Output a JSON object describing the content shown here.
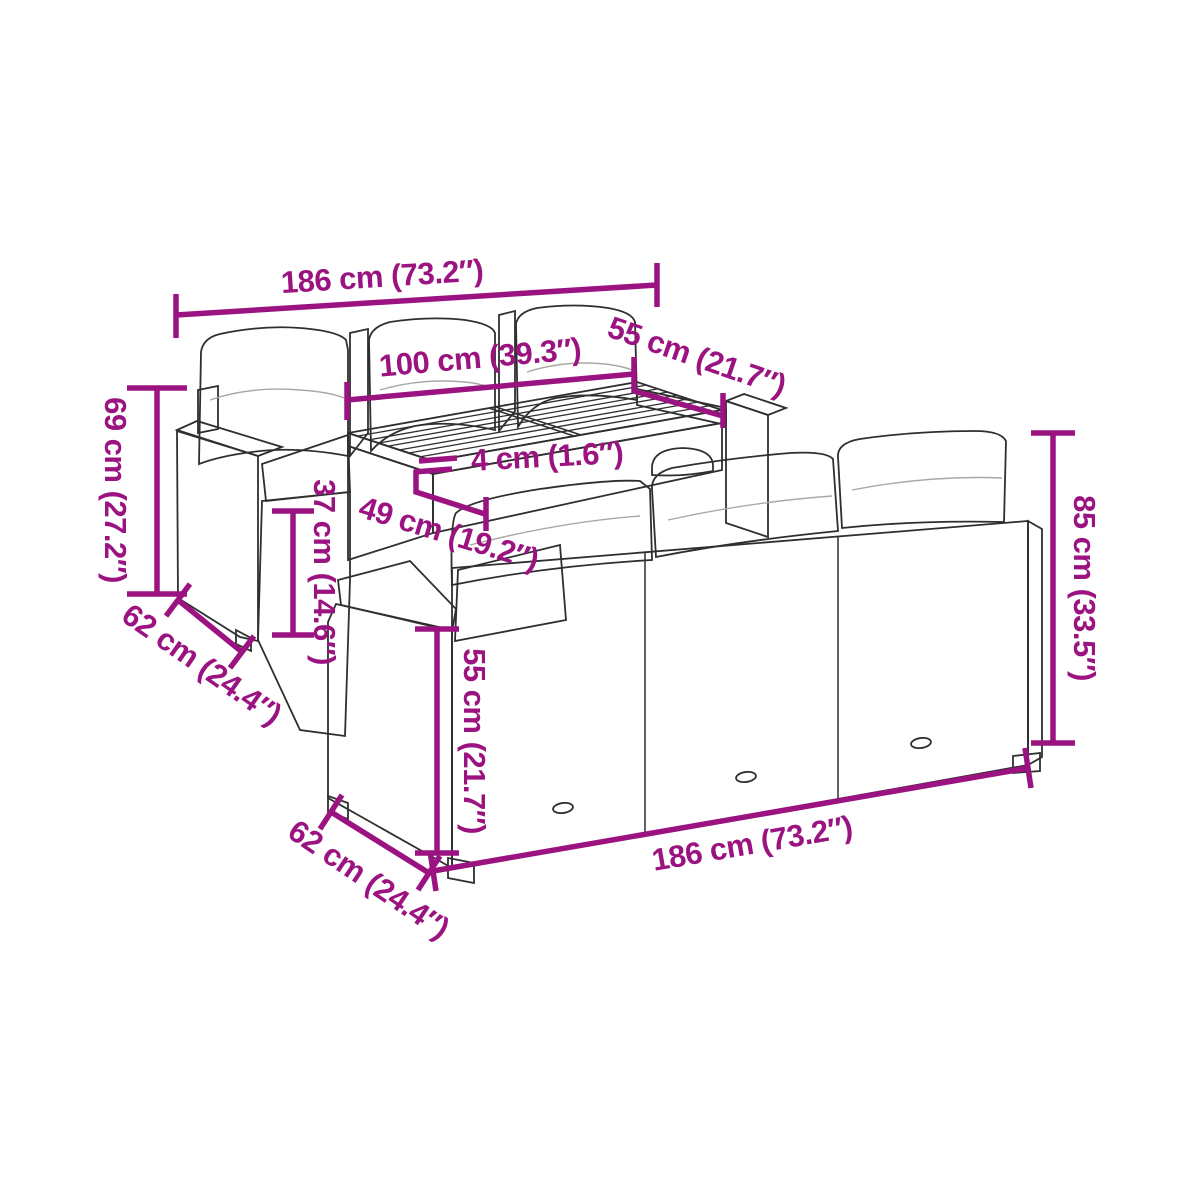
{
  "diagram": {
    "colors": {
      "background": "#ffffff",
      "dimension": "#9b1380",
      "line_art": "#2f2f2f"
    },
    "dimensions": [
      {
        "id": "top-sofa-width",
        "label": "186 cm (73.2″)"
      },
      {
        "id": "table-length",
        "label": "100 cm (39.3″)"
      },
      {
        "id": "table-depth",
        "label": "55 cm (21.7″)"
      },
      {
        "id": "tabletop-thickness",
        "label": "4 cm (1.6″)"
      },
      {
        "id": "table-height",
        "label": "49 cm (19.2″)"
      },
      {
        "id": "back-height",
        "label": "69 cm (27.2″)"
      },
      {
        "id": "top-sofa-depth",
        "label": "62 cm (24.4″)"
      },
      {
        "id": "armrest-height",
        "label": "37 cm (14.6″)"
      },
      {
        "id": "total-height",
        "label": "85 cm (33.5″)"
      },
      {
        "id": "bottom-sofa-width",
        "label": "186 cm (73.2″)"
      },
      {
        "id": "bottom-sofa-depth",
        "label": "62 cm (24.4″)"
      },
      {
        "id": "seat-height",
        "label": "55 cm (21.7″)"
      }
    ]
  }
}
